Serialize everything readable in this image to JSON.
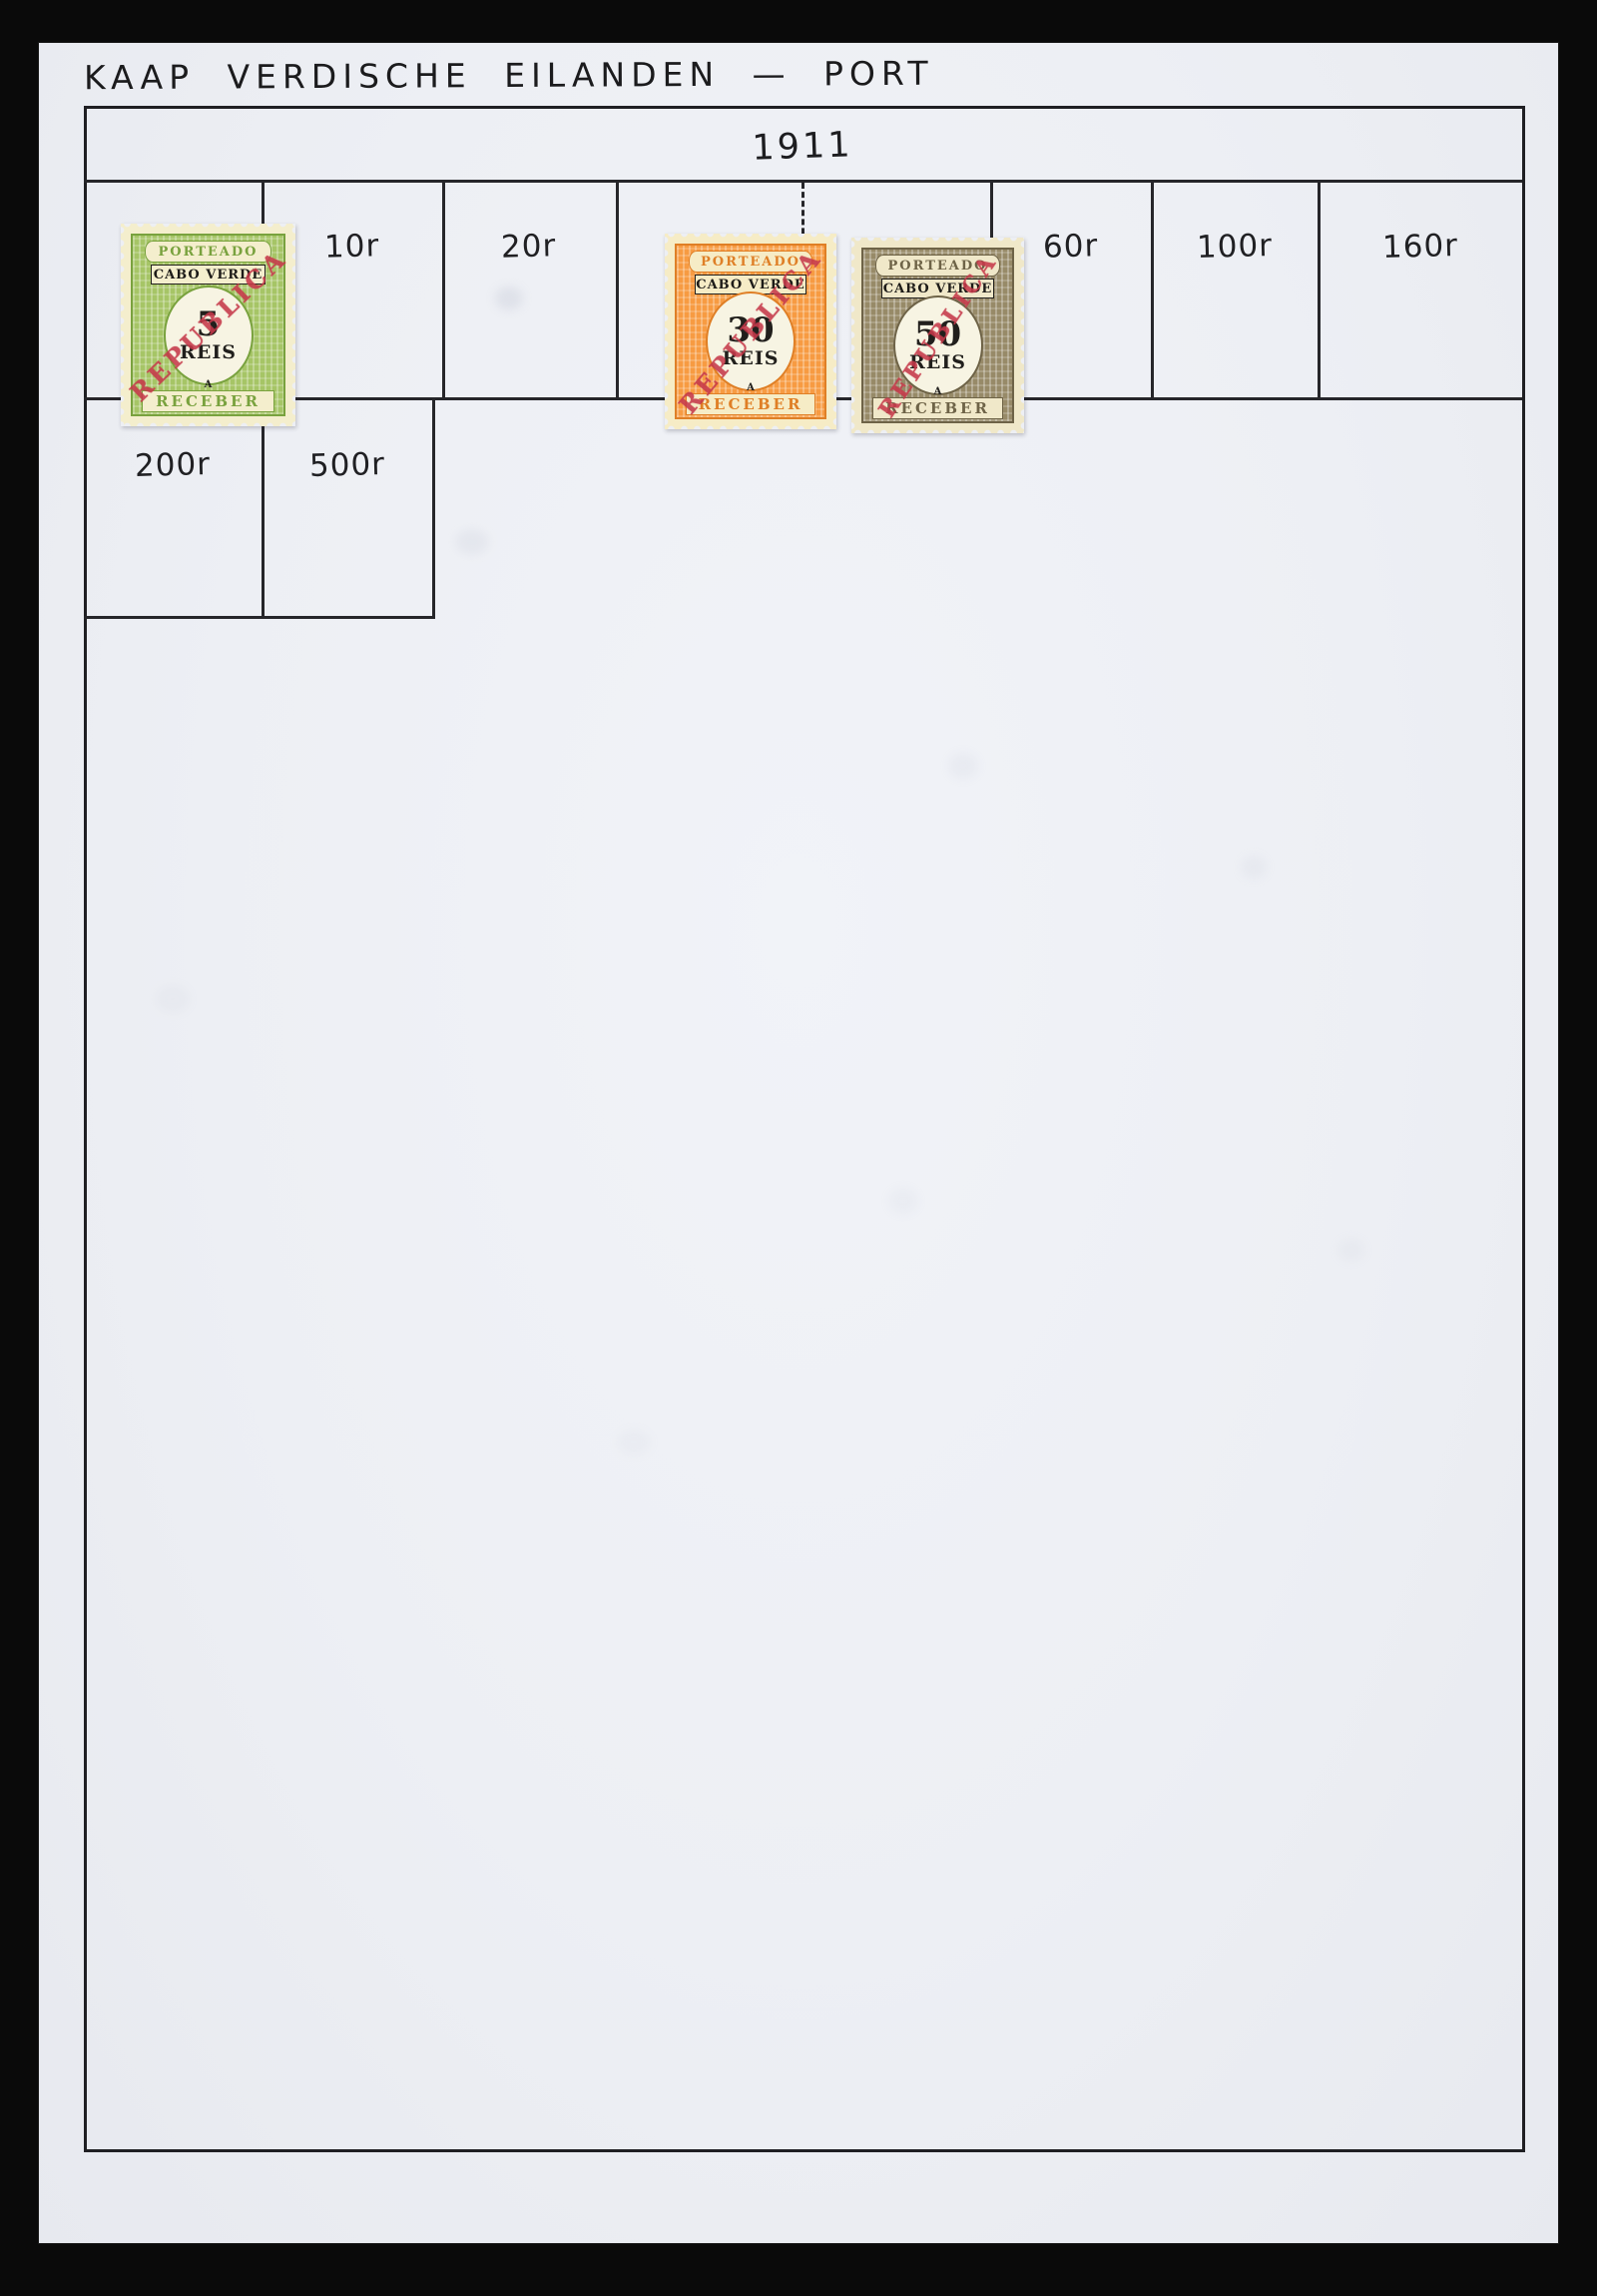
{
  "page": {
    "title": "KAAP VERDISCHE EILANDEN — PORT",
    "year": "1911"
  },
  "grid": {
    "row1": {
      "label_10r": "10r",
      "label_20r": "20r",
      "label_60r": "60r",
      "label_100r": "100r",
      "label_160r": "160r"
    },
    "row2": {
      "label_200r": "200r",
      "label_500r": "500r"
    }
  },
  "stamps": [
    {
      "name": "5 reis green postage-due stamp",
      "top_text": "PORTEADO",
      "country": "CABO VERDE",
      "value": "5",
      "unit": "REIS",
      "letter": "A",
      "bottom_text": "RECEBER",
      "overprint": "REPUBLICA",
      "colors": {
        "main": "#a6c566",
        "main_dark": "#79a23e",
        "paper": "#f4eecd",
        "overprint": "#c6394a"
      }
    },
    {
      "name": "30 reis orange postage-due stamp",
      "top_text": "PORTEADO",
      "country": "CABO VERDE",
      "value": "30",
      "unit": "REIS",
      "letter": "A",
      "bottom_text": "RECEBER",
      "overprint": "REPUBLICA",
      "colors": {
        "main": "#f79b42",
        "main_dark": "#df7f26",
        "paper": "#f6ecc6",
        "overprint": "#c6394a"
      }
    },
    {
      "name": "50 reis brown postage-due stamp",
      "top_text": "PORTEADO",
      "country": "CABO VERDE",
      "value": "50",
      "unit": "REIS",
      "letter": "A",
      "bottom_text": "RECEBER",
      "overprint": "REPUBLICA",
      "colors": {
        "main": "#978a68",
        "main_dark": "#6e6347",
        "paper": "#f0e8c9",
        "overprint": "#c6394a"
      }
    }
  ]
}
